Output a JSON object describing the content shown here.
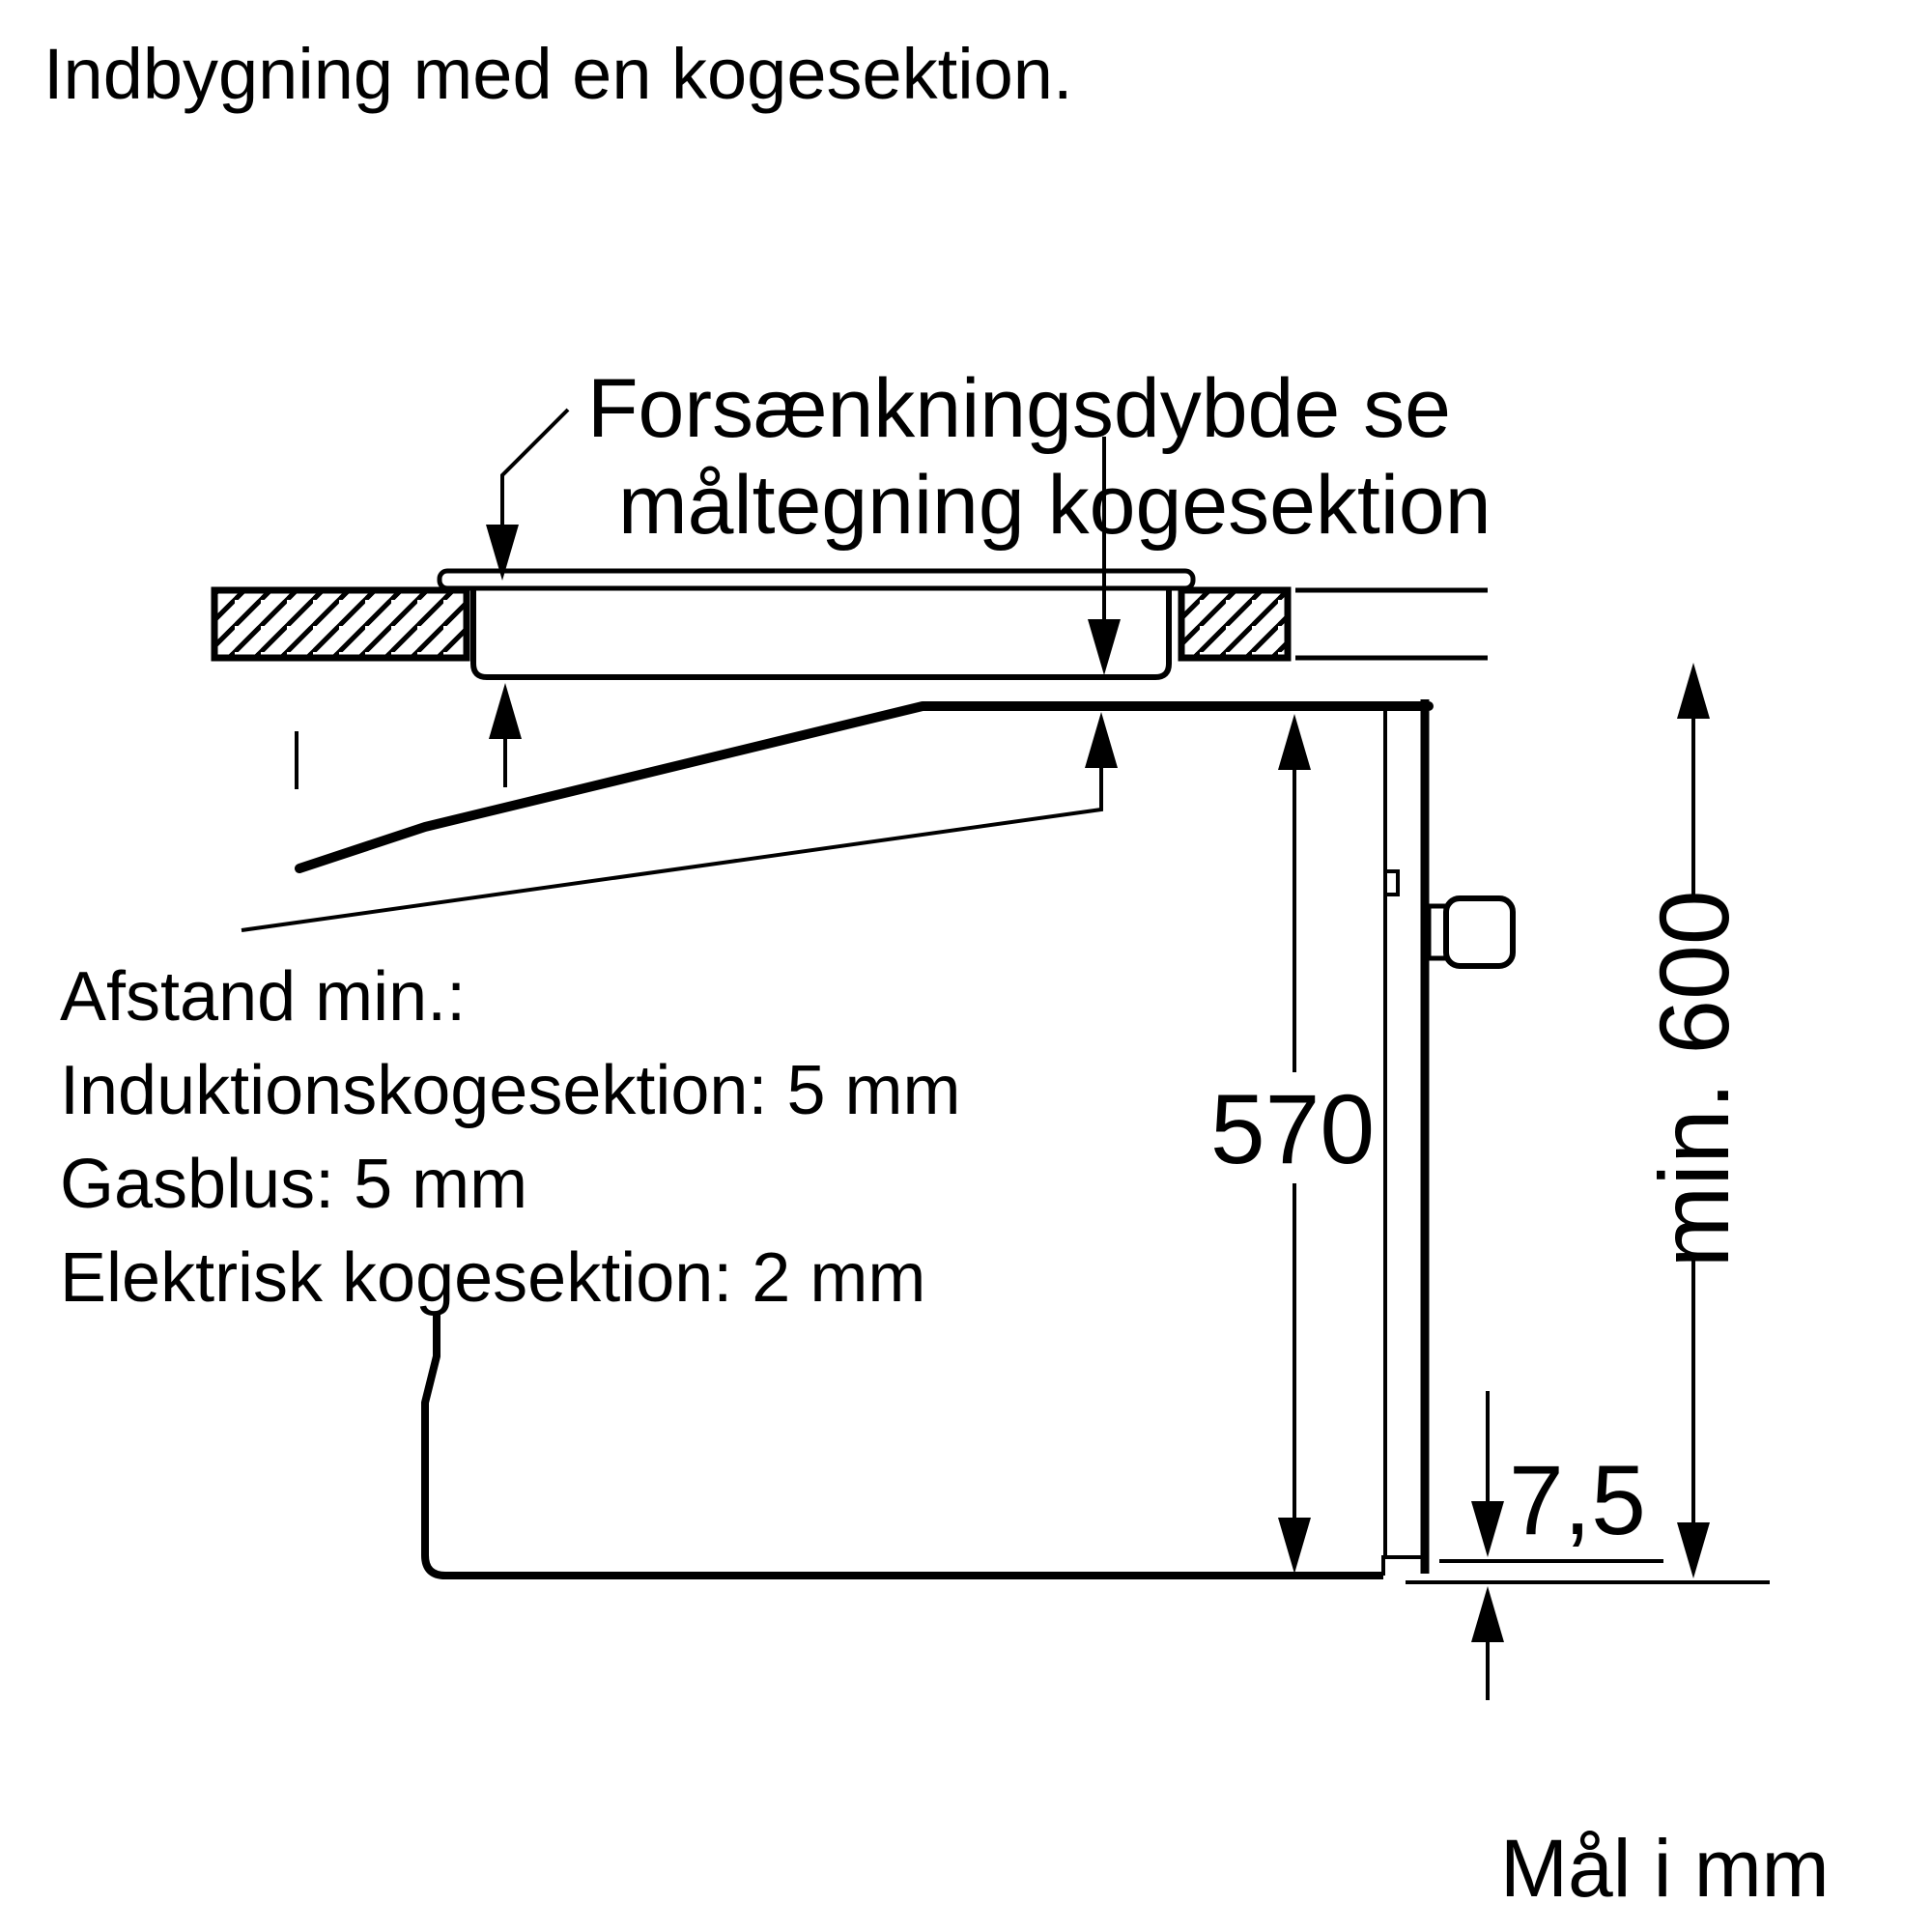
{
  "title": "Indbygning med en kogesektion.",
  "callout": {
    "line1": "Forsænkningsdybde se",
    "line2": "måltegning kogesektion"
  },
  "clearances": {
    "heading": "Afstand min.:",
    "items": [
      "Induktionskogesektion: 5 mm",
      "Gasblus: 5 mm",
      "Elektrisk kogesektion: 2 mm"
    ]
  },
  "dimensions": {
    "oven_height": "570",
    "worktop_to_floor": "min. 600",
    "door_bottom_gap": "7,5"
  },
  "footer_note": "Mål i mm",
  "colors": {
    "ink": "#000000",
    "background": "#ffffff"
  }
}
